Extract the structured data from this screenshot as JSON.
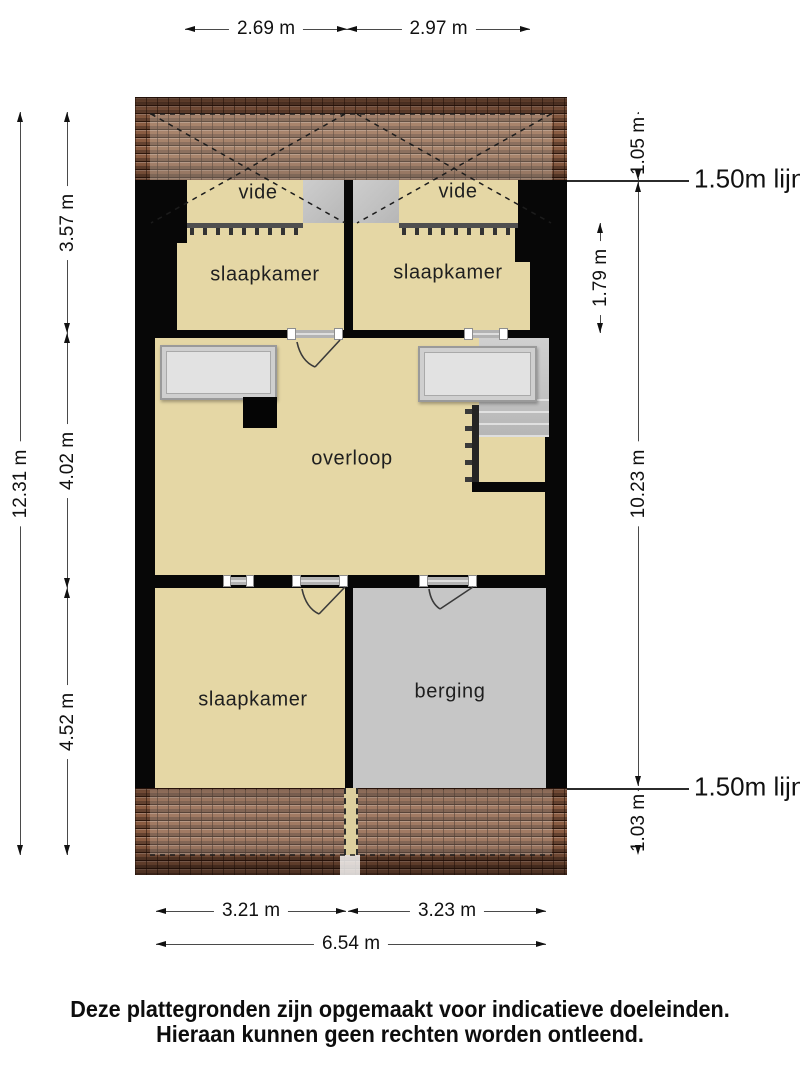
{
  "plan": {
    "rooms": {
      "vide_left": "vide",
      "vide_right": "vide",
      "slaapkamer_top_left": "slaapkamer",
      "slaapkamer_top_right": "slaapkamer",
      "overloop": "overloop",
      "slaapkamer_bottom": "slaapkamer",
      "berging": "berging"
    }
  },
  "dimensions": {
    "top": {
      "left": "2.69 m",
      "right": "2.97 m"
    },
    "left": {
      "total": "12.31 m",
      "seg1": "3.57 m",
      "seg2": "4.02 m",
      "seg3": "4.52 m"
    },
    "right": {
      "top_offset": "1.05 m",
      "room_depth": "1.79 m",
      "total": "10.23 m",
      "bottom_offset": "1.03 m",
      "line_label_top": "1.50m lijn",
      "line_label_bottom": "1.50m lijn"
    },
    "bottom": {
      "left": "3.21 m",
      "right": "3.23 m",
      "total": "6.54 m"
    }
  },
  "footer": {
    "line1": "Deze plattegronden zijn opgemaakt voor indicatieve doeleinden.",
    "line2": "Hieraan kunnen geen rechten worden ontleend."
  },
  "colors": {
    "floor": "#e5d7a5",
    "storage": "#c6c6c6",
    "stairs": "#c3c3c3",
    "wall": "#070707",
    "roof": "#8a5c42",
    "dimline": "#4a4a4a",
    "dimtext": "#111111"
  }
}
